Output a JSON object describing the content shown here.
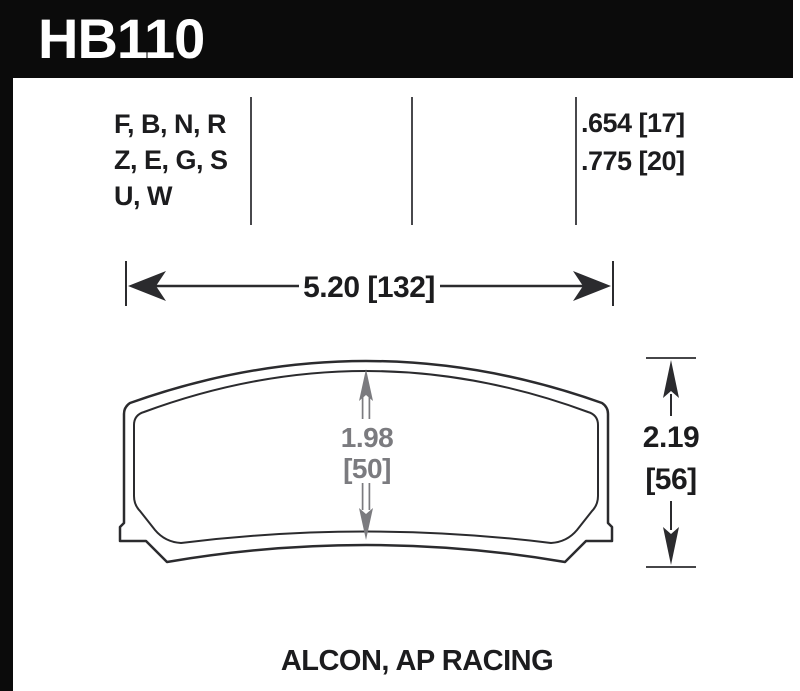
{
  "header": {
    "part_number": "HB110"
  },
  "spec_table": {
    "compounds": [
      "F, B, N, R",
      "Z, E, G, S",
      "U, W"
    ],
    "thickness_values": [
      ".654 [17]",
      ".775 [20]"
    ]
  },
  "dimensions": {
    "width": "5.20 [132]",
    "height_in": "2.19",
    "height_mm": "[56]",
    "center_height_in": "1.98",
    "center_height_mm": "[50]"
  },
  "footer": {
    "applications": "ALCON, AP RACING"
  },
  "colors": {
    "header_bar": "#0b0b0b",
    "header_text": "#ffffff",
    "line": "#2b2b2e",
    "gray_dimension": "#7b7b7f",
    "text": "#1c1c1e",
    "divider": "#48484c"
  }
}
